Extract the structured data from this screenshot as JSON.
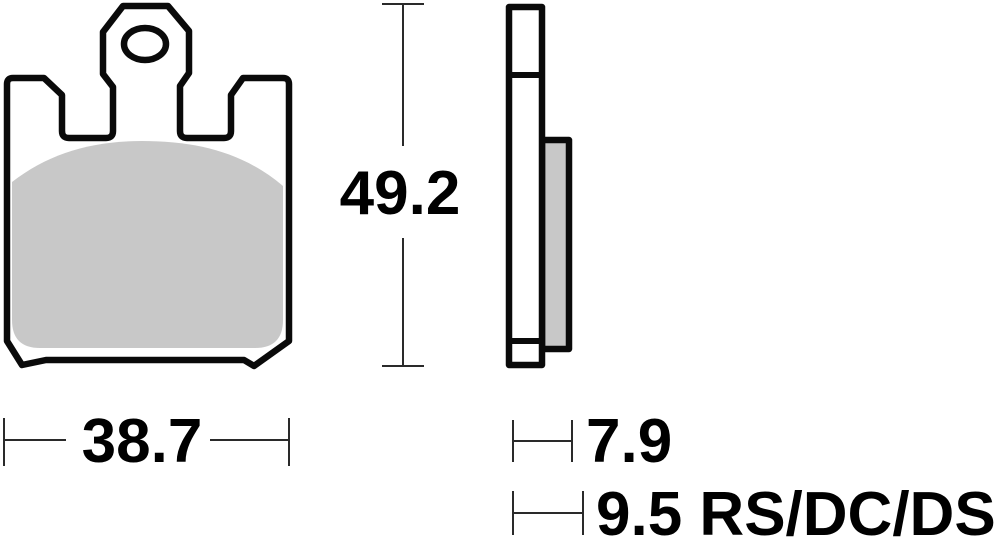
{
  "drawing": {
    "type": "brake-pad-dimensional-drawing",
    "views": {
      "front_view": "brake pad front face with backing plate outline, mounting tab with oval hole, two top retention notches and sintered friction surface",
      "profile_view": "brake pad side profile showing backing plate and friction material thickness"
    }
  },
  "colors": {
    "background": "#ffffff",
    "part_outline": "#0a0a0a",
    "friction_fill": "#c8c8c8",
    "dimension_line": "#2a2a2a",
    "dimension_text": "#000000"
  },
  "dimensions": {
    "overall_height": {
      "value": "49.2"
    },
    "overall_width": {
      "value": "38.7"
    },
    "friction_thickness": {
      "value": "7.9"
    },
    "total_thickness": {
      "value": "9.5 RS/DC/DS"
    }
  }
}
